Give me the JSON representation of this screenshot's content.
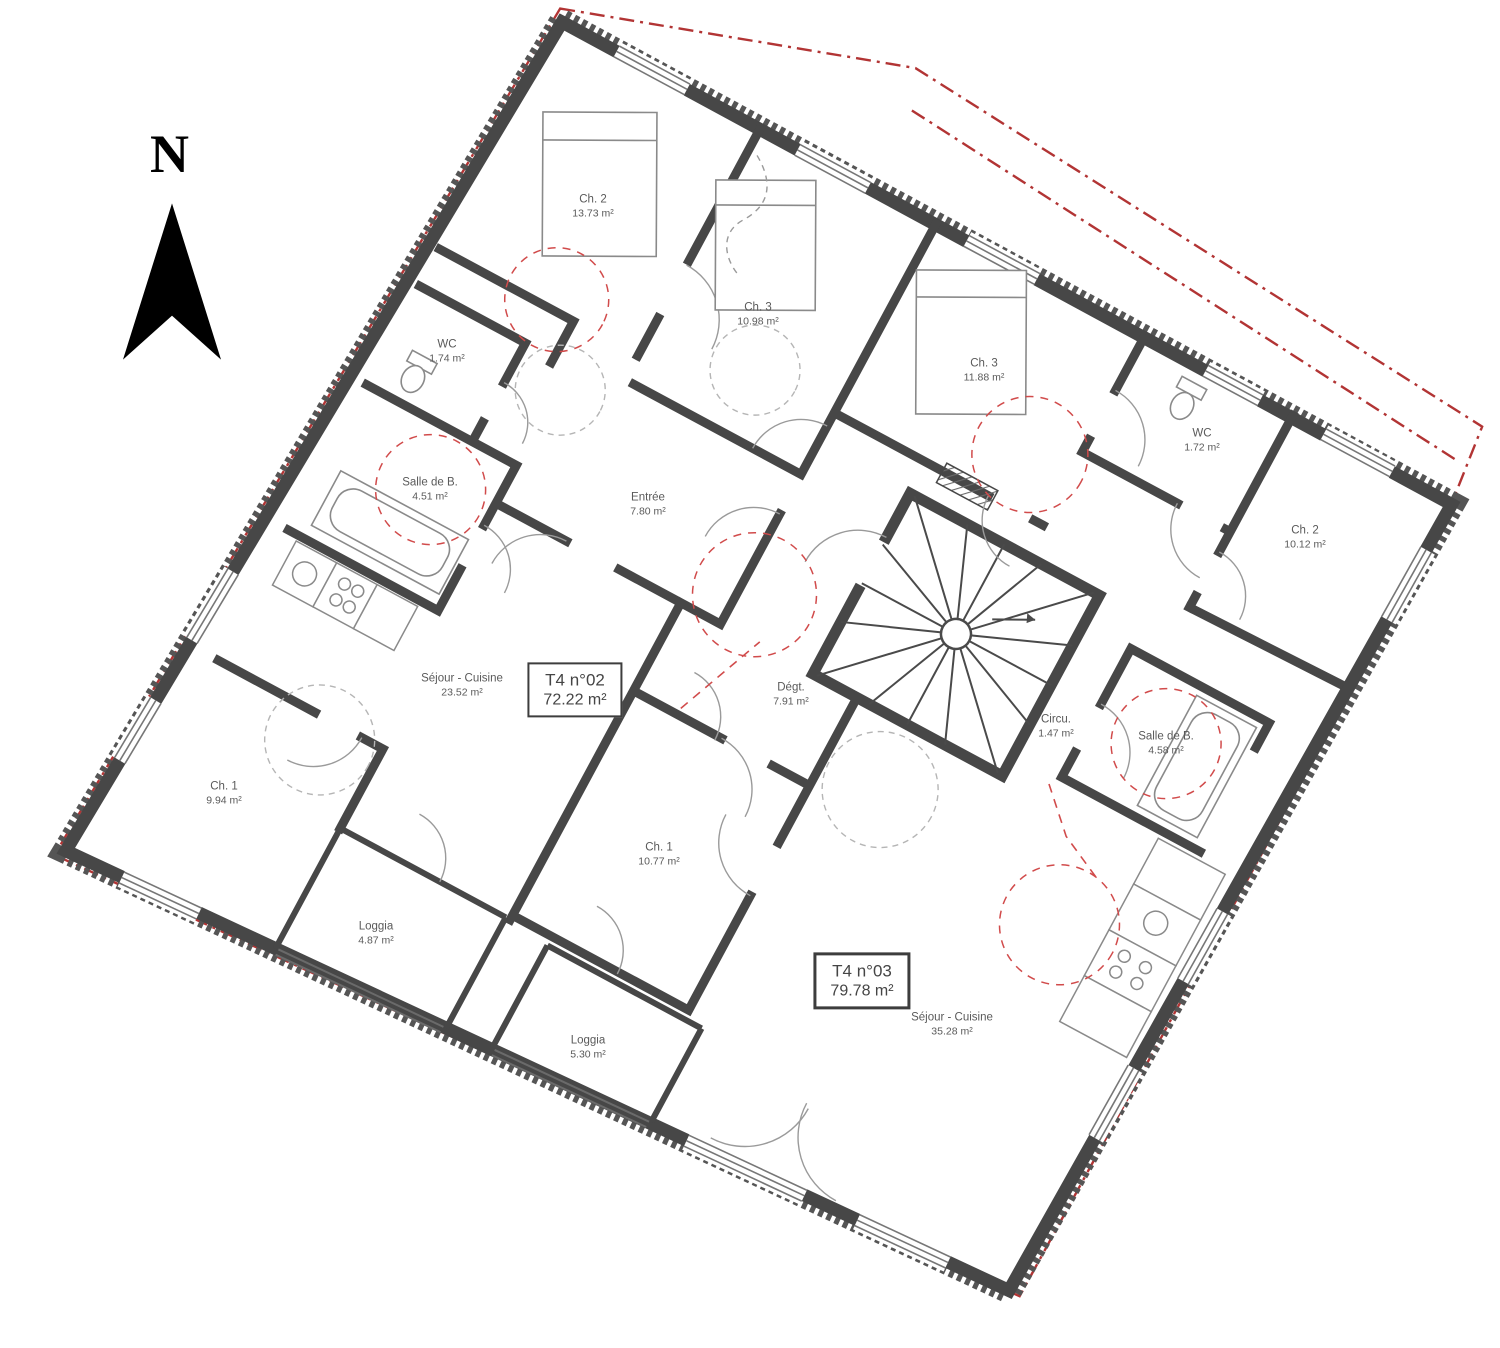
{
  "plan": {
    "north_label": "N",
    "apartment_labels": [
      {
        "name": "T4 n°02",
        "area": "72.22 m²",
        "x": 575,
        "y": 690,
        "heavy": false
      },
      {
        "name": "T4 n°03",
        "area": "79.78 m²",
        "x": 862,
        "y": 981,
        "heavy": true
      }
    ],
    "rooms": [
      {
        "name": "Ch. 2",
        "area": "13.73 m²",
        "x": 593,
        "y": 207
      },
      {
        "name": "Ch. 3",
        "area": "10.98 m²",
        "x": 758,
        "y": 315
      },
      {
        "name": "WC",
        "area": "1.74 m²",
        "x": 447,
        "y": 352
      },
      {
        "name": "Salle de B.",
        "area": "4.51 m²",
        "x": 430,
        "y": 490
      },
      {
        "name": "Entrée",
        "area": "7.80 m²",
        "x": 648,
        "y": 505
      },
      {
        "name": "Séjour - Cuisine",
        "area": "23.52 m²",
        "x": 462,
        "y": 686
      },
      {
        "name": "Ch. 1",
        "area": "9.94 m²",
        "x": 224,
        "y": 794
      },
      {
        "name": "Loggia",
        "area": "4.87 m²",
        "x": 376,
        "y": 934
      },
      {
        "name": "Loggia",
        "area": "5.30 m²",
        "x": 588,
        "y": 1048
      },
      {
        "name": "Dégt.",
        "area": "7.91 m²",
        "x": 791,
        "y": 695
      },
      {
        "name": "Ch. 3",
        "area": "11.88 m²",
        "x": 984,
        "y": 371
      },
      {
        "name": "WC",
        "area": "1.72 m²",
        "x": 1202,
        "y": 441
      },
      {
        "name": "Ch. 2",
        "area": "10.12 m²",
        "x": 1305,
        "y": 538
      },
      {
        "name": "Circu.",
        "area": "1.47 m²",
        "x": 1056,
        "y": 727
      },
      {
        "name": "Salle de B.",
        "area": "4.58 m²",
        "x": 1166,
        "y": 744
      },
      {
        "name": "Ch. 1",
        "area": "10.77 m²",
        "x": 659,
        "y": 855
      },
      {
        "name": "Séjour - Cuisine",
        "area": "35.28 m²",
        "x": 952,
        "y": 1025
      }
    ],
    "colors": {
      "wall": "#474747",
      "boundary_red": "#b23434",
      "clearance_red": "#d14b4b",
      "line_gray": "#8f8f8f",
      "text": "#5a5a5a"
    }
  }
}
